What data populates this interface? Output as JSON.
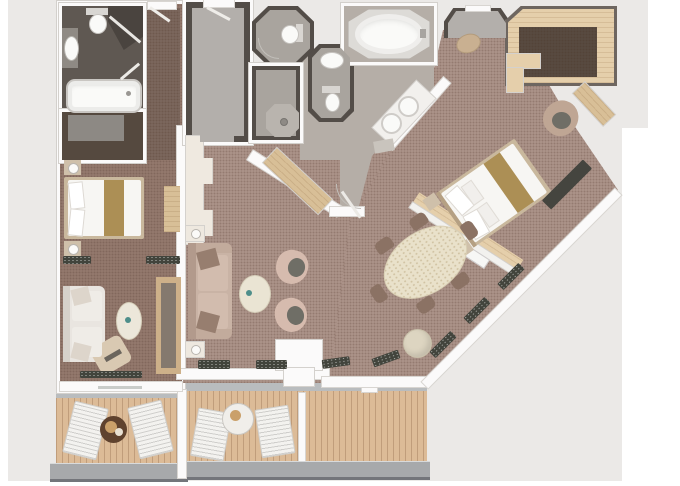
{
  "scene": {
    "title": "Two-bedroom suite floor plan (top-down 3D render, no text labels)",
    "type": "floor-plan",
    "background": "#ffffff",
    "canvas_color": "#ebe9e7"
  },
  "palette": {
    "wall": "#fbfafa",
    "wall_line": "#d3d0cc",
    "dark_wall": "#534d48",
    "carpet_living": "#ab9288",
    "carpet_left": "#93786d",
    "corridor": "#7b665c",
    "bath_dark": "#5f5852",
    "bath_gray": "#a9a49e",
    "bath_light": "#b5aea7",
    "foyer_floor": "#b3afab",
    "deck": "#dcbb97",
    "threshold": "#b9bcbe",
    "railing": "#a7a9ab",
    "wood": "#d8bf97",
    "wood_floor": "#e5cfab",
    "closet_carpet": "#584a40",
    "white_fixture": "#fafaf8",
    "bed_runner": "#ac8f55",
    "sofa_living": "#c9b3a5",
    "sofa_left": "#e9e5e0",
    "armchair": "#d6bbae",
    "cushion_dark": "#6f6e66",
    "dining_table": "#e9e1ca",
    "dining_chair": "#8b7264",
    "pouf": "#ddd5c1",
    "sill_plant": "#42443c",
    "lounger": "#f3f2ef",
    "balcony_table_dark": "#5f422e"
  },
  "rooms": [
    {
      "id": "guest-bathroom",
      "furniture": [
        "bathtub",
        "toilet",
        "corner-shower",
        "vanity-sink"
      ]
    },
    {
      "id": "guest-closet",
      "furniture": [
        "rug"
      ]
    },
    {
      "id": "guest-bedroom",
      "furniture": [
        "queen-bed",
        "nightstand-top",
        "nightstand-bottom",
        "dresser",
        "sofa",
        "oval-coffee-table",
        "lounge-chair",
        "media-cabinet",
        "curtain-divider"
      ]
    },
    {
      "id": "guest-balcony",
      "furniture": [
        "lounger-left",
        "lounger-right",
        "drinks-table",
        "railing"
      ]
    },
    {
      "id": "entry-foyer",
      "furniture": [
        "entry-door"
      ]
    },
    {
      "id": "powder-room",
      "furniture": [
        "toilet"
      ]
    },
    {
      "id": "shower-room",
      "furniture": [
        "walk-in-shower-pan"
      ]
    },
    {
      "id": "water-closet",
      "furniture": [
        "sink",
        "toilet"
      ]
    },
    {
      "id": "master-bathroom",
      "furniture": [
        "soaking-tub",
        "double-vanity",
        "bath-mat"
      ]
    },
    {
      "id": "living-room",
      "furniture": [
        "sofa",
        "end-table-top",
        "end-table-bottom",
        "armchair-top",
        "armchair-bottom",
        "coffee-table",
        "bar-cabinet",
        "wood-sideboard",
        "window-planters",
        "balcony-door"
      ]
    },
    {
      "id": "dining-area",
      "furniture": [
        "oval-dining-table",
        "dining-chairs-x6",
        "round-pouf"
      ]
    },
    {
      "id": "master-bedroom",
      "furniture": [
        "king-bed",
        "nightstands",
        "headboard-wall",
        "tv-console",
        "desk",
        "tub-chair",
        "window-bench",
        "entry-ottoman"
      ]
    },
    {
      "id": "walk-in-closet",
      "furniture": [
        "l-shaped-counter",
        "wood-floor-border"
      ]
    },
    {
      "id": "main-balcony",
      "furniture": [
        "lounger-left",
        "lounger-right",
        "breakfast-table",
        "privacy-divider",
        "railing"
      ]
    }
  ]
}
